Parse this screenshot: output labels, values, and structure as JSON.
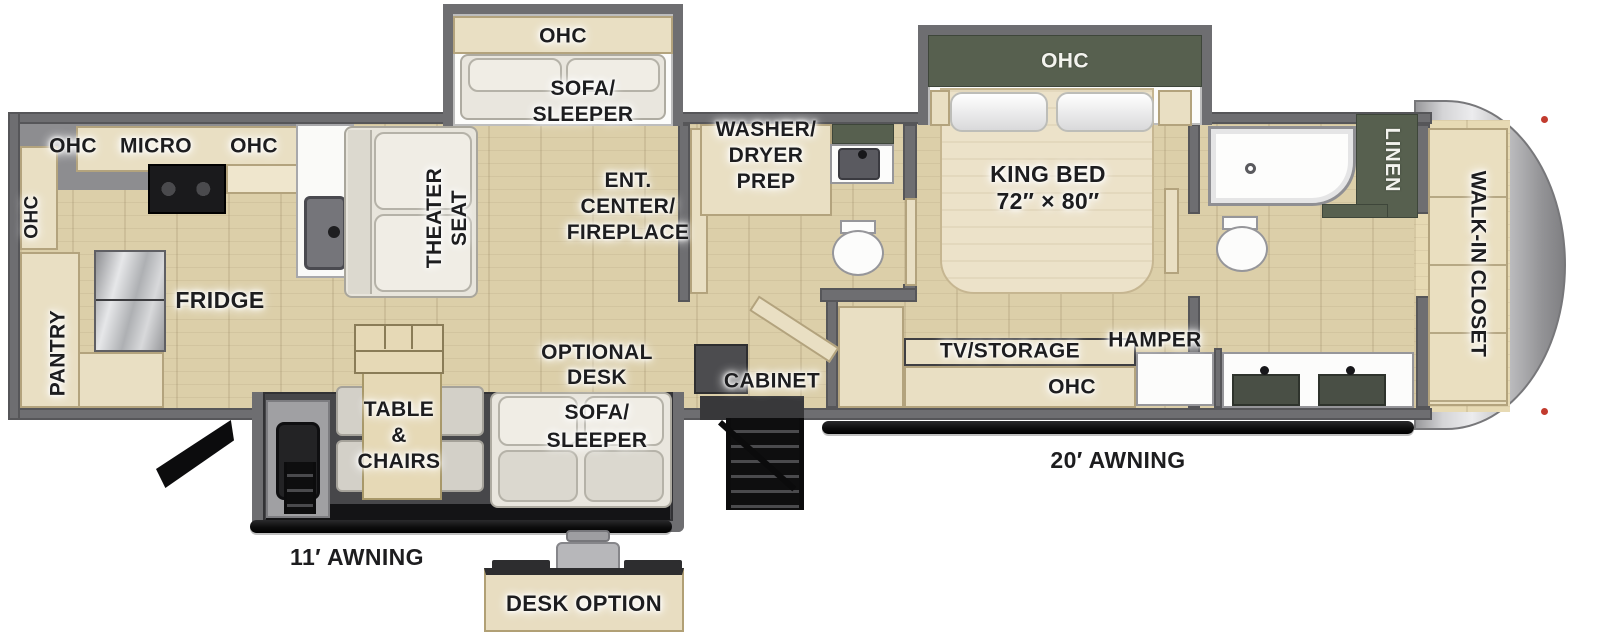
{
  "colors": {
    "wall_gray": "#6e6e71",
    "floor_wood": "#dccfa9",
    "cabinet_cream": "#e9dfc3",
    "dark_green_cabinet": "#57604f",
    "fixture_white": "#fcfcfb",
    "awning_black": "#0d0d0e",
    "front_cap_silver": "#c9c9cb",
    "label_text": "#1d1d1f",
    "label_text_light": "#f3f3ee",
    "sofa_fabric": "#e9e6de",
    "stainless": "#c4c5c8"
  },
  "labels": {
    "kitchen": {
      "ohc_side": "OHC",
      "ohc_left": "OHC",
      "micro": "MICRO",
      "ohc_right": "OHC",
      "pantry": "PANTRY",
      "fridge": "FRIDGE"
    },
    "living": {
      "theater_seat": [
        "THEATER",
        "SEAT"
      ],
      "sofa_slide_ohc": "OHC",
      "sofa_sleeper": [
        "SOFA/",
        "SLEEPER"
      ],
      "ent_center": [
        "ENT.",
        "CENTER/",
        "FIREPLACE"
      ],
      "optional_desk": [
        "OPTIONAL",
        "DESK"
      ],
      "sofa_sleeper_lower": [
        "SOFA/",
        "SLEEPER"
      ],
      "dinette": [
        "TABLE",
        "&",
        "CHAIRS"
      ],
      "cabinet": "CABINET"
    },
    "bath_mid": {
      "washer_dryer_prep": [
        "WASHER/",
        "DRYER",
        "PREP"
      ]
    },
    "bedroom": {
      "king_bed": [
        "KING BED",
        "72″ × 80″"
      ],
      "ohc_slide": "OHC",
      "tv_storage": "TV/STORAGE",
      "hamper": "HAMPER",
      "ohc_dresser": "OHC"
    },
    "bath_rear": {
      "linen": "LINEN"
    },
    "closet": {
      "walk_in": "WALK-IN CLOSET"
    },
    "exterior": {
      "awning_11": "11′ AWNING",
      "awning_20": "20′ AWNING",
      "desk_option": "DESK OPTION"
    }
  }
}
